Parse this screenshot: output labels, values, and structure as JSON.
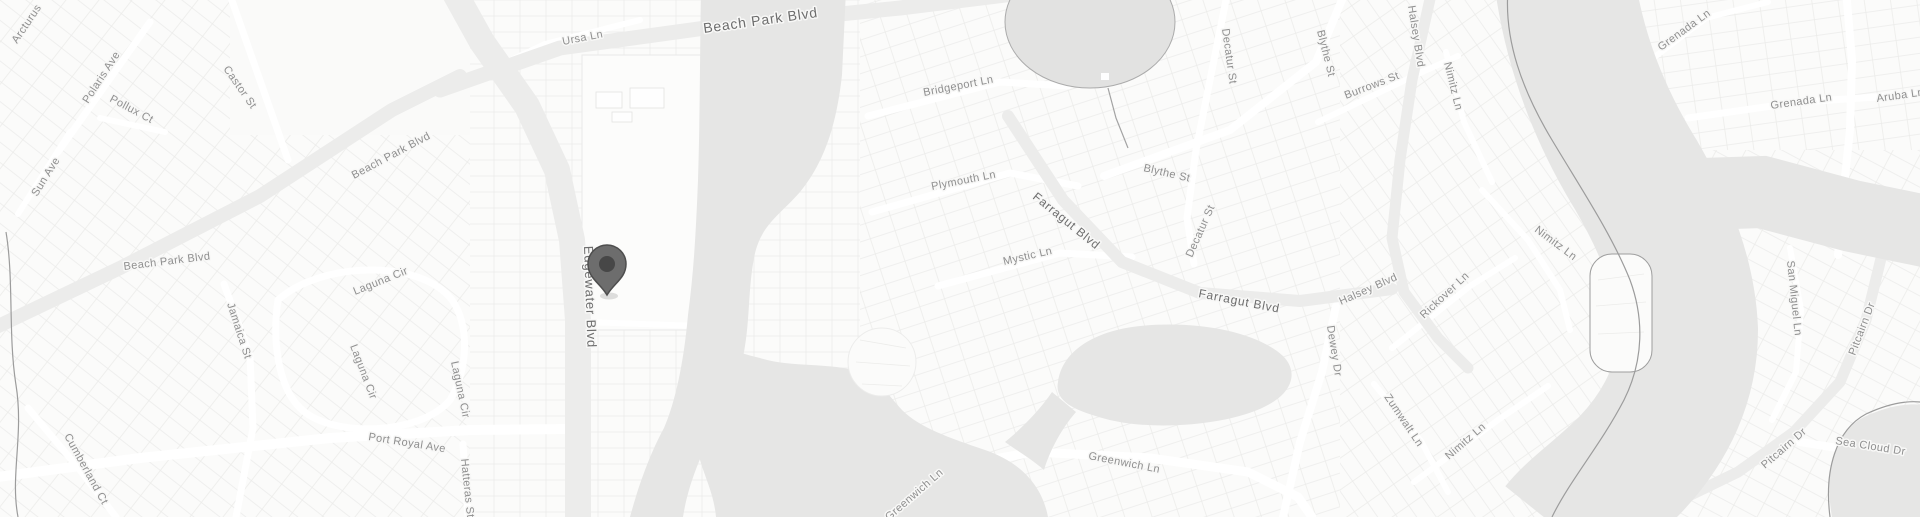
{
  "map": {
    "type": "grayscale-road-map",
    "palette": {
      "background": "#f7f7f6",
      "parcel_fill": "#fbfbfa",
      "parcel_line": "#ececea",
      "major_road": "#ececeb",
      "minor_road": "#ffffff",
      "water": "#e6e6e5",
      "pond": "#e2e2e1",
      "shoreline": "#9c9c9c",
      "label_minor": "#8f8f8f",
      "label_major": "#6d6d6d",
      "marker_body": "#6d6d6d",
      "marker_outline": "#4e4e4e",
      "marker_dot": "#474747"
    },
    "marker": {
      "name": "location-pin",
      "x": 607,
      "y": 295
    },
    "labels": [
      {
        "text": "Arcturus",
        "x": 17,
        "y": 44,
        "r": -56,
        "s": 11,
        "major": false
      },
      {
        "text": "Polaris Ave",
        "x": 88,
        "y": 104,
        "r": -57,
        "s": 11,
        "major": false
      },
      {
        "text": "Pollux Ct",
        "x": 109,
        "y": 101,
        "r": 28,
        "s": 11,
        "major": false
      },
      {
        "text": "Castor St",
        "x": 223,
        "y": 69,
        "r": 55,
        "s": 11,
        "major": false
      },
      {
        "text": "Sun Ave",
        "x": 37,
        "y": 197,
        "r": -58,
        "s": 11,
        "major": false
      },
      {
        "text": "Beach Park Blvd",
        "x": 354,
        "y": 179,
        "r": -28,
        "s": 11,
        "major": false
      },
      {
        "text": "Beach Park Blvd",
        "x": 124,
        "y": 270,
        "r": -7,
        "s": 11,
        "major": false
      },
      {
        "text": "Ursa Ln",
        "x": 563,
        "y": 45,
        "r": -11,
        "s": 11,
        "major": false
      },
      {
        "text": "Beach Park Blvd",
        "x": 704,
        "y": 33,
        "r": -8,
        "s": 14,
        "major": true
      },
      {
        "text": "Edgewater Blvd",
        "x": 584,
        "y": 246,
        "r": 88,
        "s": 13,
        "major": true
      },
      {
        "text": "Jamaica St",
        "x": 227,
        "y": 304,
        "r": 72,
        "s": 11,
        "major": false
      },
      {
        "text": "Laguna Cir",
        "x": 355,
        "y": 295,
        "r": -22,
        "s": 11,
        "major": false
      },
      {
        "text": "Laguna Cir",
        "x": 350,
        "y": 346,
        "r": 69,
        "s": 11,
        "major": false
      },
      {
        "text": "Laguna Cir",
        "x": 451,
        "y": 362,
        "r": 78,
        "s": 11,
        "major": false
      },
      {
        "text": "Port Royal Ave",
        "x": 368,
        "y": 440,
        "r": 9,
        "s": 11,
        "major": false
      },
      {
        "text": "Cumberland Ct",
        "x": 64,
        "y": 436,
        "r": 61,
        "s": 11,
        "major": false
      },
      {
        "text": "Hatteras St",
        "x": 461,
        "y": 459,
        "r": 84,
        "s": 11,
        "major": false
      },
      {
        "text": "Bridgeport Ln",
        "x": 924,
        "y": 96,
        "r": -11,
        "s": 11,
        "major": false
      },
      {
        "text": "Plymouth Ln",
        "x": 932,
        "y": 190,
        "r": -11,
        "s": 11,
        "major": false
      },
      {
        "text": "Mystic Ln",
        "x": 1004,
        "y": 265,
        "r": -13,
        "s": 11,
        "major": false
      },
      {
        "text": "Farragut Blvd",
        "x": 1032,
        "y": 198,
        "r": 39,
        "s": 12,
        "major": true
      },
      {
        "text": "Farragut Blvd",
        "x": 1198,
        "y": 297,
        "r": 11,
        "s": 12,
        "major": true
      },
      {
        "text": "Blythe St",
        "x": 1143,
        "y": 171,
        "r": 13,
        "s": 11,
        "major": false
      },
      {
        "text": "Blythe St",
        "x": 1317,
        "y": 31,
        "r": 76,
        "s": 11,
        "major": false
      },
      {
        "text": "Decatur St",
        "x": 1222,
        "y": 29,
        "r": 82,
        "s": 11,
        "major": false
      },
      {
        "text": "Decatur St",
        "x": 1192,
        "y": 258,
        "r": -66,
        "s": 11,
        "major": false
      },
      {
        "text": "Burrows St",
        "x": 1346,
        "y": 99,
        "r": -21,
        "s": 11,
        "major": false
      },
      {
        "text": "Halsey Blvd",
        "x": 1408,
        "y": 6,
        "r": 81,
        "s": 11,
        "major": false
      },
      {
        "text": "Halsey Blvd",
        "x": 1341,
        "y": 305,
        "r": -24,
        "s": 11,
        "major": false
      },
      {
        "text": "Nimitz Ln",
        "x": 1444,
        "y": 63,
        "r": 76,
        "s": 11,
        "major": false
      },
      {
        "text": "Nimitz Ln",
        "x": 1534,
        "y": 231,
        "r": 37,
        "s": 11,
        "major": false
      },
      {
        "text": "Nimitz Ln",
        "x": 1449,
        "y": 460,
        "r": -41,
        "s": 11,
        "major": false
      },
      {
        "text": "Dewey Dr",
        "x": 1327,
        "y": 326,
        "r": 81,
        "s": 11,
        "major": false
      },
      {
        "text": "Rickover Ln",
        "x": 1424,
        "y": 319,
        "r": -43,
        "s": 11,
        "major": false
      },
      {
        "text": "Zumwalt Ln",
        "x": 1384,
        "y": 397,
        "r": 56,
        "s": 11,
        "major": false
      },
      {
        "text": "Greenwich Ln",
        "x": 1088,
        "y": 459,
        "r": 11,
        "s": 11,
        "major": false
      },
      {
        "text": "Greenwich Ln",
        "x": 889,
        "y": 521,
        "r": -41,
        "s": 11,
        "major": false
      },
      {
        "text": "Grenada Ln",
        "x": 1661,
        "y": 51,
        "r": -36,
        "s": 11,
        "major": false
      },
      {
        "text": "Grenada Ln",
        "x": 1771,
        "y": 109,
        "r": -8,
        "s": 11,
        "major": false
      },
      {
        "text": "Aruba Ln",
        "x": 1877,
        "y": 102,
        "r": -8,
        "s": 11,
        "major": false
      },
      {
        "text": "San Miguel Ln",
        "x": 1787,
        "y": 261,
        "r": 84,
        "s": 11,
        "major": false
      },
      {
        "text": "Pitcairn Dr",
        "x": 1855,
        "y": 356,
        "r": -69,
        "s": 11,
        "major": false
      },
      {
        "text": "Pitcairn Dr",
        "x": 1765,
        "y": 469,
        "r": -41,
        "s": 11,
        "major": false
      },
      {
        "text": "Sea Cloud Dr",
        "x": 1835,
        "y": 444,
        "r": 9,
        "s": 11,
        "major": false
      }
    ]
  }
}
